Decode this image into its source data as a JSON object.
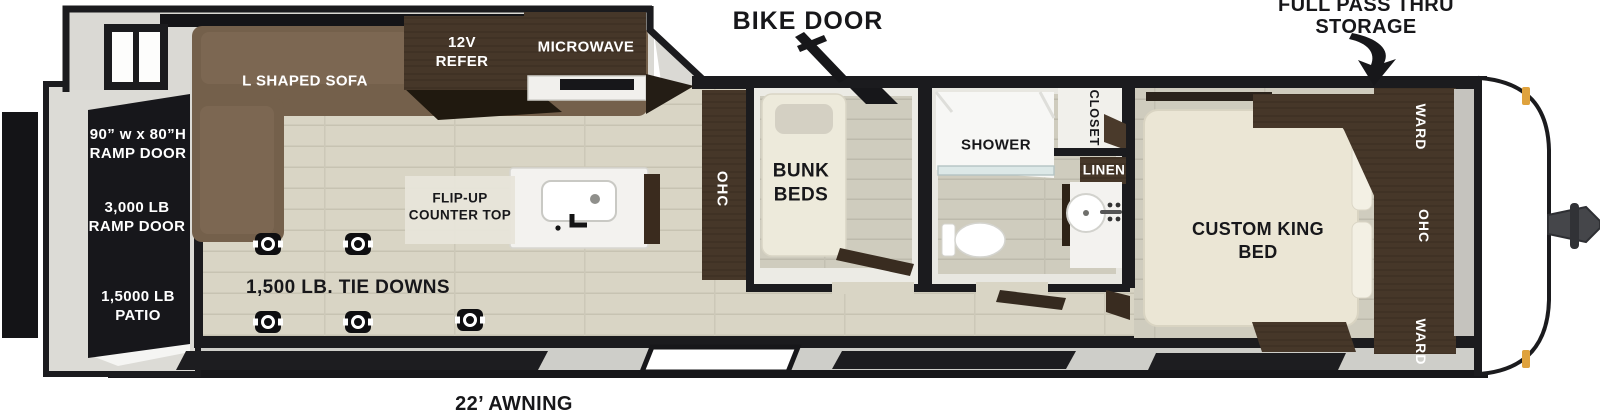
{
  "floorplan": {
    "title": "travel-trailer-floorplan",
    "annotations": {
      "bike_door": "BIKE DOOR",
      "storage": "FULL PASS THRU\nSTORAGE",
      "awning": "22’ AWNING",
      "tie_downs": "1,500 LB. TIE DOWNS"
    },
    "rear": {
      "ramp_size": "90” w x 80”H\nRAMP DOOR",
      "ramp_capacity": "3,000 LB\nRAMP DOOR",
      "patio": "1,5000 LB\nPATIO"
    },
    "galley": {
      "sofa": "L SHAPED SOFA",
      "refer": "12V\nREFER",
      "microwave": "MICROWAVE",
      "flip_up": "FLIP-UP\nCOUNTER TOP",
      "ohc": "OHC"
    },
    "bunk_room": {
      "label": "BUNK\nBEDS"
    },
    "bathroom": {
      "shower": "SHOWER",
      "closet": "CLOSET",
      "linen": "LINEN"
    },
    "bedroom": {
      "bed": "CUSTOM KING\nBED",
      "ward_top": "WARD",
      "ohc": "OHC",
      "ward_bottom": "WARD"
    },
    "colors": {
      "wall": "#17171a",
      "floor": "#d9d5c5",
      "cabinet_wood": "#463729",
      "sofa": "#74604b",
      "mattress": "#ece7d6",
      "marker_light": "#dfa23d"
    }
  }
}
